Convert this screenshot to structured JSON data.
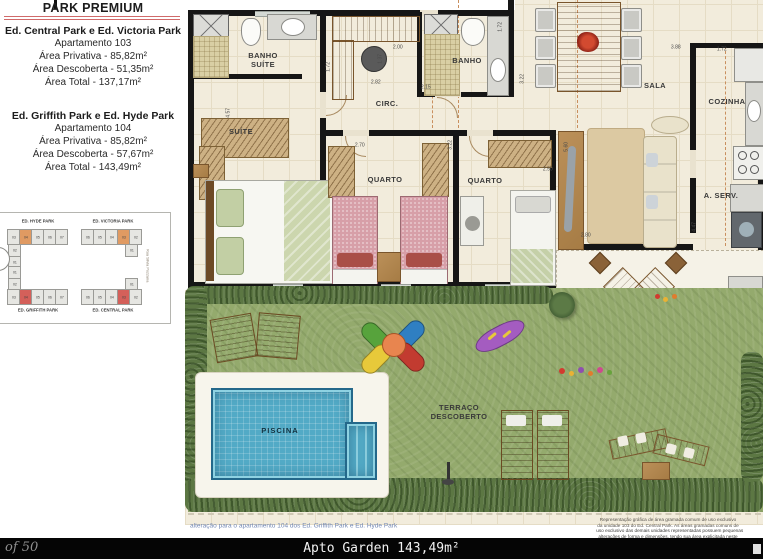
{
  "panel": {
    "title": "PARK PREMIUM",
    "block1": {
      "heading": "Ed. Central Park e Ed. Victoria Park",
      "lines": [
        "Apartamento 103",
        "Área Privativa - 85,82m²",
        "Área Descoberta - 51,35m²",
        "Área Total - 137,17m²"
      ]
    },
    "block2": {
      "heading": "Ed. Griffith Park e Ed. Hyde Park",
      "lines": [
        "Apartamento 104",
        "Área Privativa - 85,82m²",
        "Área Descoberta - 57,67m²",
        "Área Total - 143,49m²"
      ]
    }
  },
  "keyplan": {
    "buildings": [
      {
        "label": "ED. HYDE PARK",
        "units": [
          "03",
          "04",
          "05",
          "06",
          "07"
        ],
        "side": [
          "02",
          "01"
        ]
      },
      {
        "label": "ED. VICTORIA PARK",
        "units": [
          "06",
          "05",
          "04",
          "03",
          "02"
        ],
        "side": [
          "01"
        ]
      },
      {
        "label": "ED. GRIFFITH PARK",
        "units": [
          "03",
          "04",
          "05",
          "06",
          "07"
        ],
        "side": [
          "01",
          "02"
        ]
      },
      {
        "label": "ED. CENTRAL PARK",
        "units": [
          "06",
          "05",
          "04",
          "03",
          "02"
        ],
        "side": [
          "01"
        ]
      }
    ],
    "street": "Rua Silvia Pozzana"
  },
  "plan": {
    "rooms": {
      "banho_suite_1": "BANHO",
      "banho_suite_2": "SUÍTE",
      "banho": "BANHO",
      "circ": "CIRC.",
      "suite": "SUÍTE",
      "quarto1": "QUARTO",
      "quarto2": "QUARTO",
      "sala": "SALA",
      "cozinha": "COZINHA",
      "aserv": "A. SERV.",
      "terraco_1": "TERRAÇO",
      "terraco_2": "DESCOBERTO",
      "piscina": "PISCINA",
      "projection": "projeção pavimento superior"
    },
    "dimensions": [
      "4.57",
      "2.82",
      "1.37",
      "1.72",
      "2.00",
      "2.15",
      "1.72",
      "3.22",
      "2.70",
      "3.22",
      "2.50",
      "5.60",
      "2.80",
      "4.47",
      "3.88",
      "1.72"
    ]
  },
  "captions": {
    "alteration": "alteração para o apartamento 104 dos Ed. Griffith Park e Ed. Hyde Park",
    "disclaimer": [
      "Representação gráfica de área gramada comum de uso exclusivo",
      "da unidade 103 do Ed. Central Park. As áreas gramadas comuns de",
      "uso exclusivo das demais unidades representadas possuem pequenas",
      "alterações de forma e dimensões, tendo sua área explicitada neste"
    ]
  },
  "footer": {
    "page": "of 50",
    "title": "Apto Garden 143,49m²"
  },
  "colors": {
    "accent_red_line": "#d06a6a",
    "caption_blue": "#7187b4",
    "highlight_orange": "#e09a62",
    "highlight_red": "#d4605a",
    "pool_blue": "#52aac6",
    "grass_green": "#94aa6d",
    "footer_black": "#050505"
  }
}
